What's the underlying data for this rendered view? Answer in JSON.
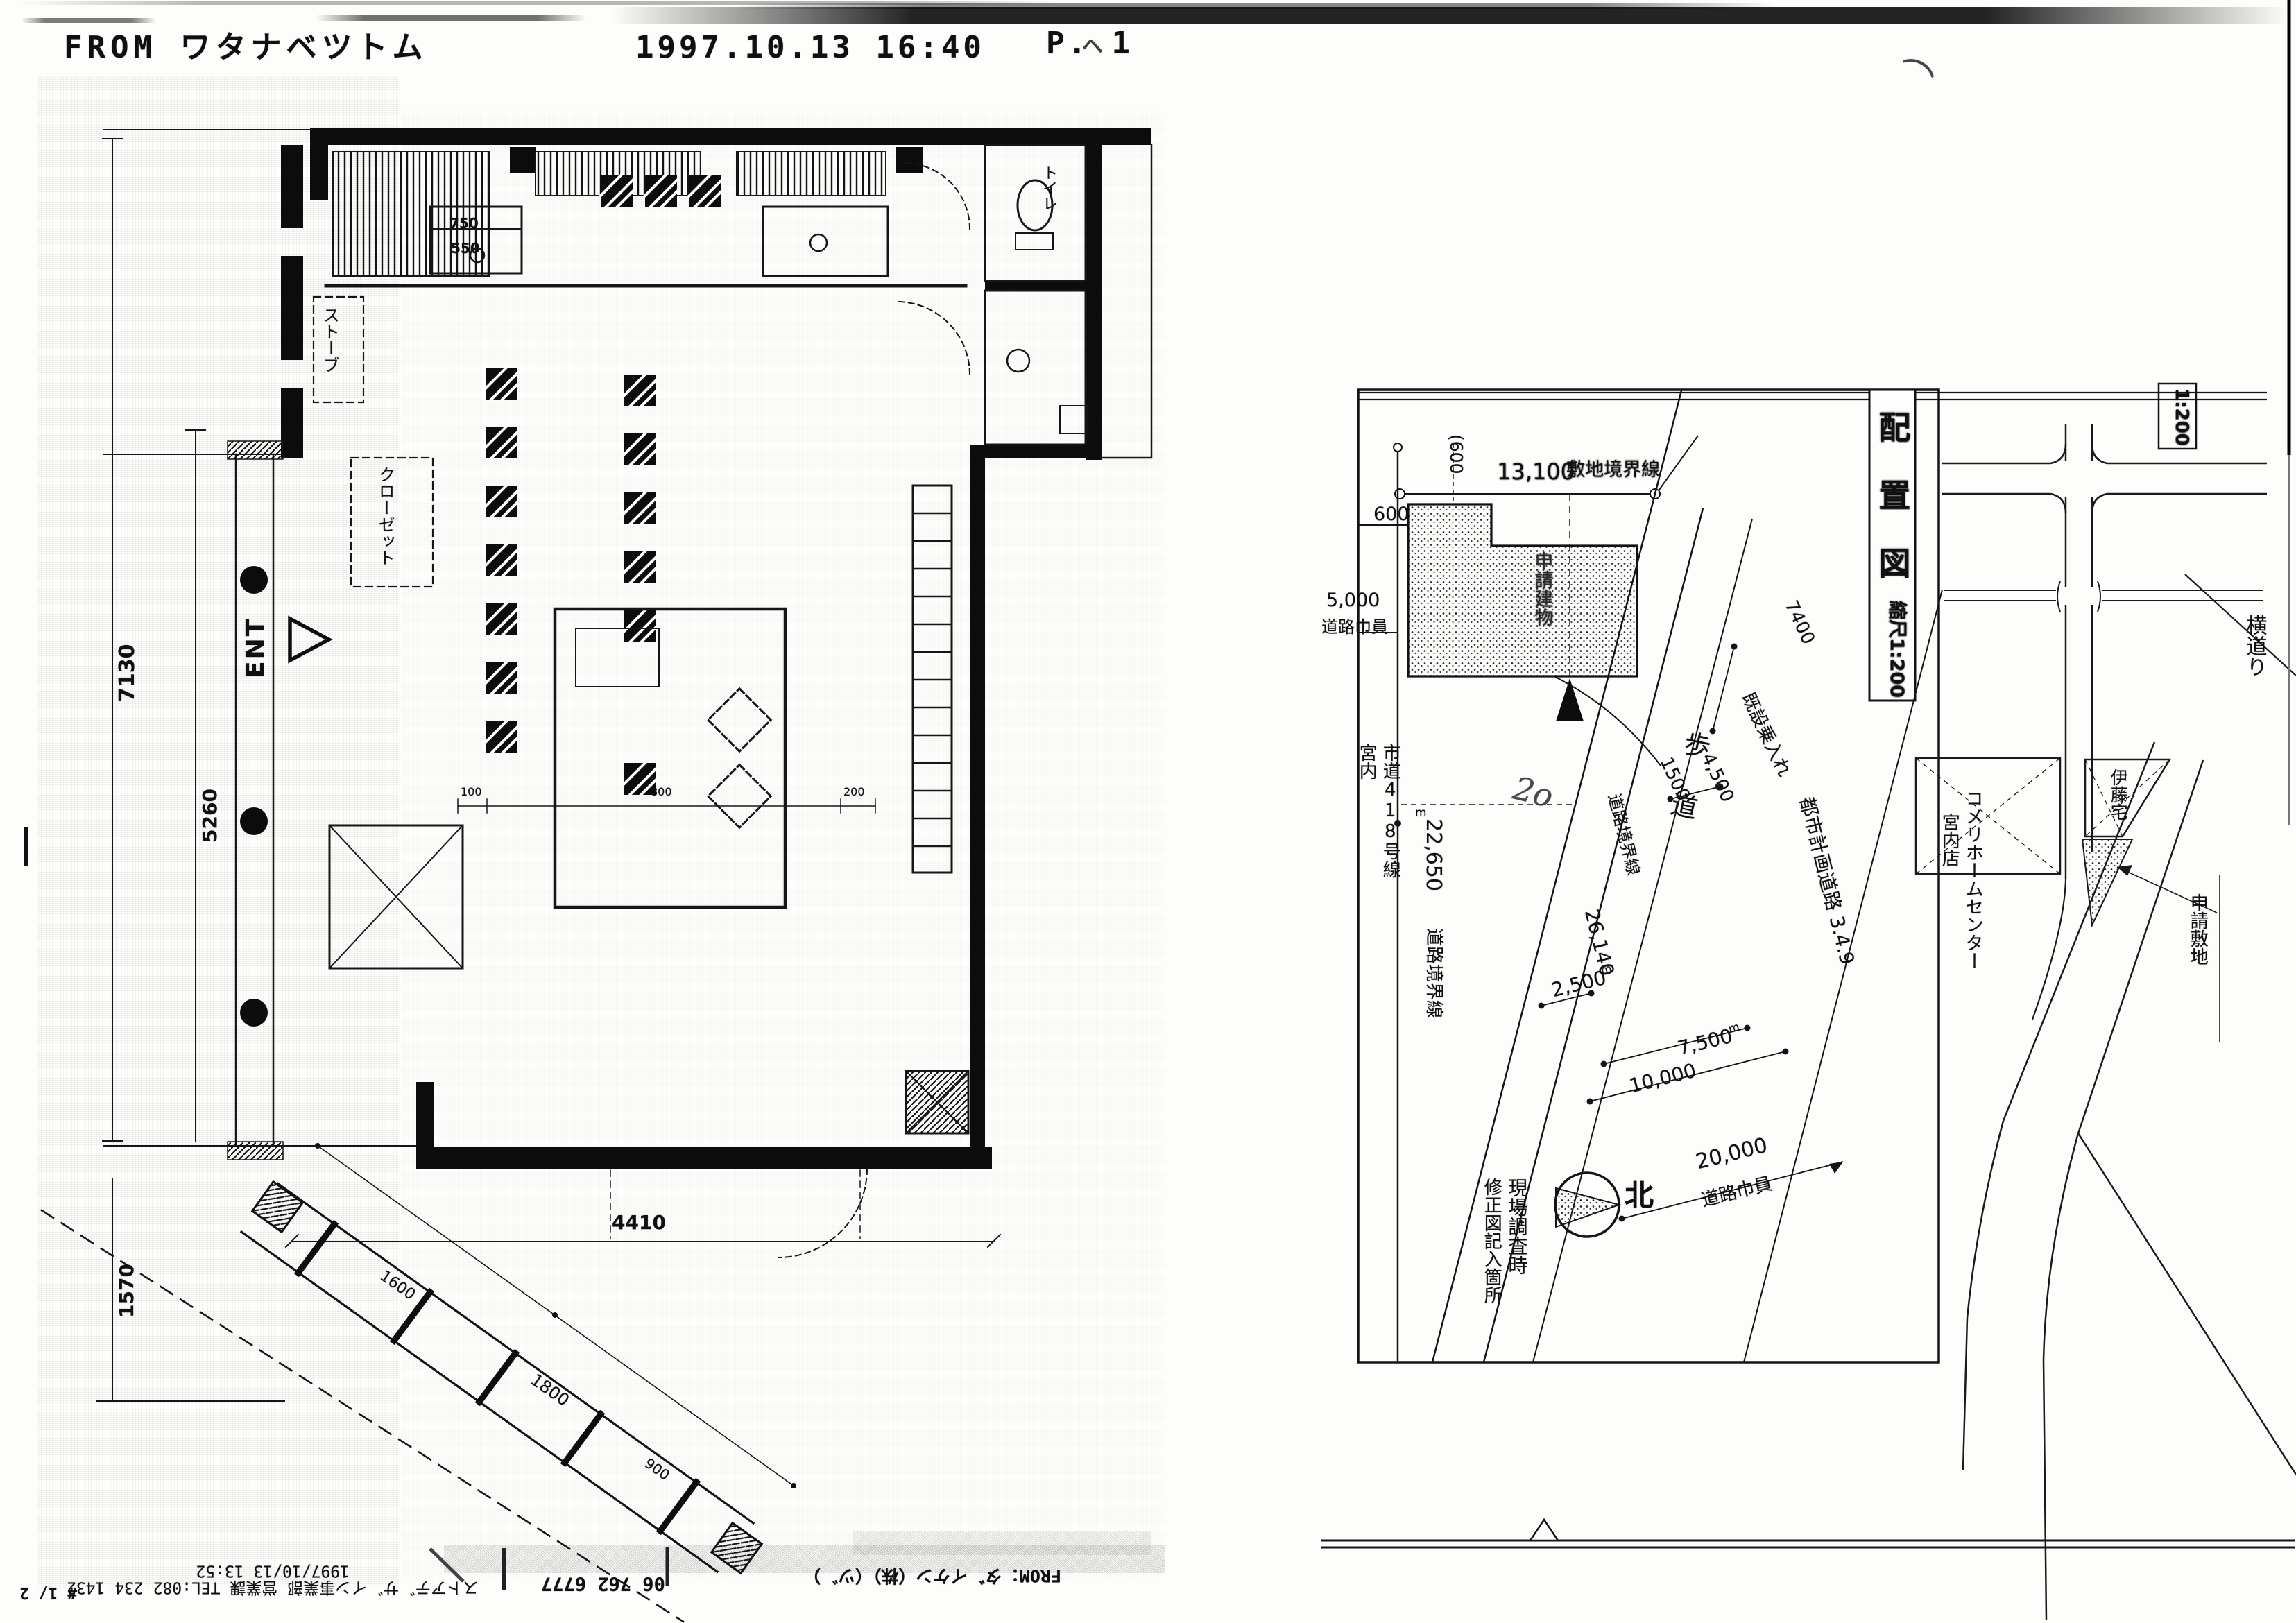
{
  "fax_header": {
    "from": "FROM ワタナベツトム",
    "datetime": "1997.10.13  16:40",
    "page": "P. 1",
    "caret": "ヘ"
  },
  "marks": {
    "squiggle": "⌒",
    "scribble": "2o"
  },
  "floor_plan": {
    "labels": {
      "ent": "ENT",
      "stove": "ストーブ",
      "closet": "クローゼット",
      "toilet": "トイレ"
    },
    "dims": {
      "v_total": "7130",
      "v_lower": "5260",
      "h_bottom": "4410",
      "v_entry": "1570",
      "d750": "750",
      "d550": "550",
      "d100": "100",
      "d800": "800",
      "d200": "200",
      "ramp_a": "1600",
      "ramp_b": "1800",
      "ramp_c": "900"
    }
  },
  "site_plan": {
    "title": "配置図",
    "scale": "縮尺1:200",
    "scale_partial": "1:200",
    "building_label": "申請建物",
    "unit": "m",
    "dims": {
      "site_width": "13,100",
      "site_boundary": "敷地境界線",
      "offset_600_paren": "(600",
      "offset_600": "600",
      "road_width_w": "5,000",
      "road_width_w_label": "道路巾員",
      "road_len": "22,650",
      "road_boundary_v": "道路境界線",
      "boundary_len_diag": "26,140",
      "boundary_diag_label": "道路境界線",
      "w1500": "1500",
      "w4500": "4,500",
      "entry_label": "既設乗入れ",
      "sidewalk_len": "7400",
      "sidewalk": "歩道",
      "w2500": "2,500",
      "w7500": "7,500",
      "w10000": "10,000",
      "w20000": "20,000",
      "road_width_label2": "道路巾員"
    },
    "roads": {
      "miyauchi": "宮内",
      "city_road": "市道418号線",
      "planning_road": "都市計画道路 3.4.9"
    },
    "notes": {
      "survey1": "現場調査時",
      "survey2": "修正図記入箇所",
      "north": "北"
    }
  },
  "street_sketch": {
    "komeri1": "コメリホームセンター",
    "komeri2": "宮内店",
    "ito": "伊藤宅",
    "side_street": "横道り",
    "applicant": "申請敷地"
  },
  "footer": {
    "sender_line": "ストアテ゛サ゛イン事業部 営業課 TEL:082 234 1432",
    "datetime_line": "1997/10/13 13:52",
    "page_no": "# 1/ 2",
    "phone": "06 762 6777",
    "from": "FROM：タ゛イケン（株）（ツ゛）"
  }
}
